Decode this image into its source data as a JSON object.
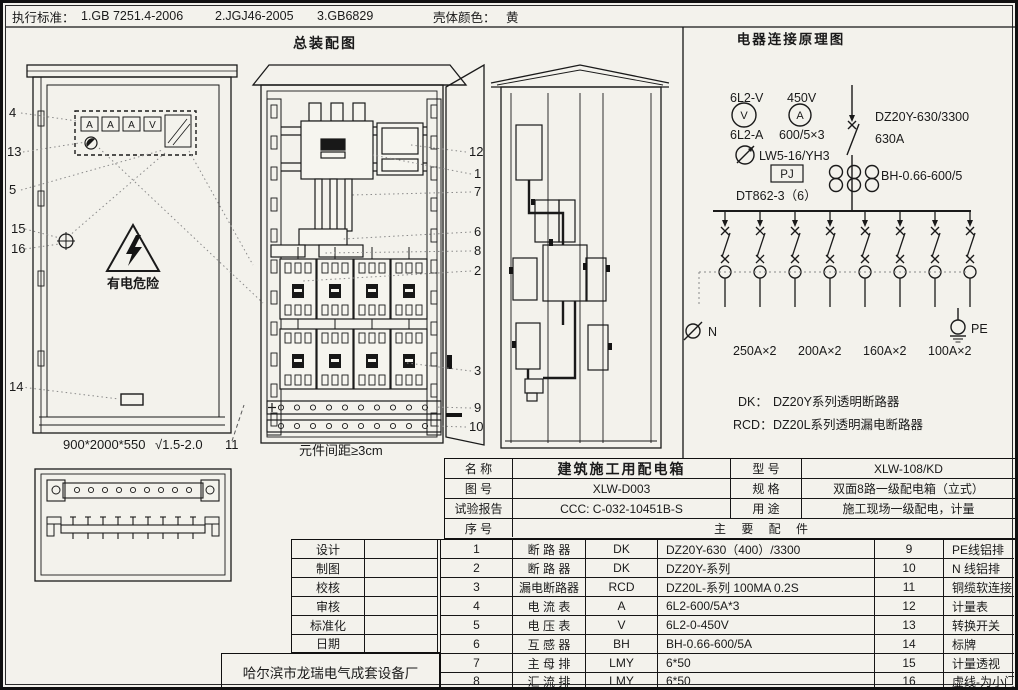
{
  "header": {
    "standards_label": "执行标准：",
    "standard_1": "1.GB 7251.4-2006",
    "standard_2": "2.JGJ46-2005",
    "standard_3": "3.GB6829",
    "shell_color_label": "壳体颜色：",
    "shell_color_value": "黄"
  },
  "assembly": {
    "title": "总装配图",
    "meters": [
      "A",
      "A",
      "A",
      "V"
    ],
    "warning_text": "有电危险",
    "dimensions": "900*2000*550",
    "finish": "√1.5-2.0",
    "door_callout": "11",
    "spacing_note": "元件间距≥3cm",
    "front_callouts": [
      "4",
      "13",
      "5",
      "15",
      "16",
      "14"
    ],
    "internal_callouts": [
      "12",
      "1",
      "7",
      "6",
      "8",
      "2",
      "3",
      "9",
      "10"
    ]
  },
  "schematic": {
    "title": "电器连接原理图",
    "voltmeter_label": "6L2-V",
    "voltmeter_range": "450V",
    "voltmeter_symbol": "V",
    "ammeter_symbol": "A",
    "ammeter_label": "6L2-A",
    "ct_ratio": "600/5×3",
    "selector_label": "LW5-16/YH3",
    "meter_box_label": "PJ",
    "energy_meter": "DT862-3（6）",
    "main_breaker_model": "DZ20Y-630/3300",
    "main_breaker_rating": "630A",
    "ct_model": "BH-0.66-600/5",
    "neutral_label": "N",
    "pe_label": "PE",
    "branch_ratings": [
      "250A×2",
      "200A×2",
      "160A×2",
      "100A×2"
    ],
    "note_dk_code": "DK：",
    "note_dk_desc": "DZ20Y系列透明断路器",
    "note_rcd_code": "RCD：",
    "note_rcd_desc": "DZ20L系列透明漏电断路器"
  },
  "title_block": {
    "rows": [
      {
        "label": "名  称",
        "value": "建筑施工用配电箱",
        "label2": "型  号",
        "value2": "XLW-108/KD"
      },
      {
        "label": "图  号",
        "value": "XLW-D003",
        "label2": "规  格",
        "value2": "双面8路一级配电箱（立式）"
      },
      {
        "label": "试验报告",
        "value": "CCC: C-032-10451B-S",
        "label2": "用  途",
        "value2": "施工现场一级配电，计量"
      }
    ],
    "serial_header": "序  号",
    "parts_header": "主  要  配  件",
    "sign_rows": [
      "设计",
      "制图",
      "校核",
      "审核",
      "标准化",
      "日期"
    ],
    "factory": "哈尔滨市龙瑞电气成套设备厂",
    "parts": [
      {
        "no": "1",
        "name": "断 路 器",
        "code": "DK",
        "spec": "DZ20Y-630（400）/3300",
        "no2": "9",
        "name2": "PE线铝排"
      },
      {
        "no": "2",
        "name": "断 路 器",
        "code": "DK",
        "spec": "DZ20Y-系列",
        "no2": "10",
        "name2": "N 线铝排"
      },
      {
        "no": "3",
        "name": "漏电断路器",
        "code": "RCD",
        "spec": "DZ20L-系列 100MA 0.2S",
        "no2": "11",
        "name2": "铜缆软连接"
      },
      {
        "no": "4",
        "name": "电 流 表",
        "code": "A",
        "spec": "6L2-600/5A*3",
        "no2": "12",
        "name2": "计量表"
      },
      {
        "no": "5",
        "name": "电 压 表",
        "code": "V",
        "spec": "6L2-0-450V",
        "no2": "13",
        "name2": "转换开关"
      },
      {
        "no": "6",
        "name": "互 感 器",
        "code": "BH",
        "spec": "BH-0.66-600/5A",
        "no2": "14",
        "name2": "标牌"
      },
      {
        "no": "7",
        "name": "主 母 排",
        "code": "LMY",
        "spec": "6*50",
        "no2": "15",
        "name2": "计量透视"
      },
      {
        "no": "8",
        "name": "汇 流 排",
        "code": "LMY",
        "spec": "6*50",
        "no2": "16",
        "name2": "虚线-为小门"
      }
    ]
  }
}
